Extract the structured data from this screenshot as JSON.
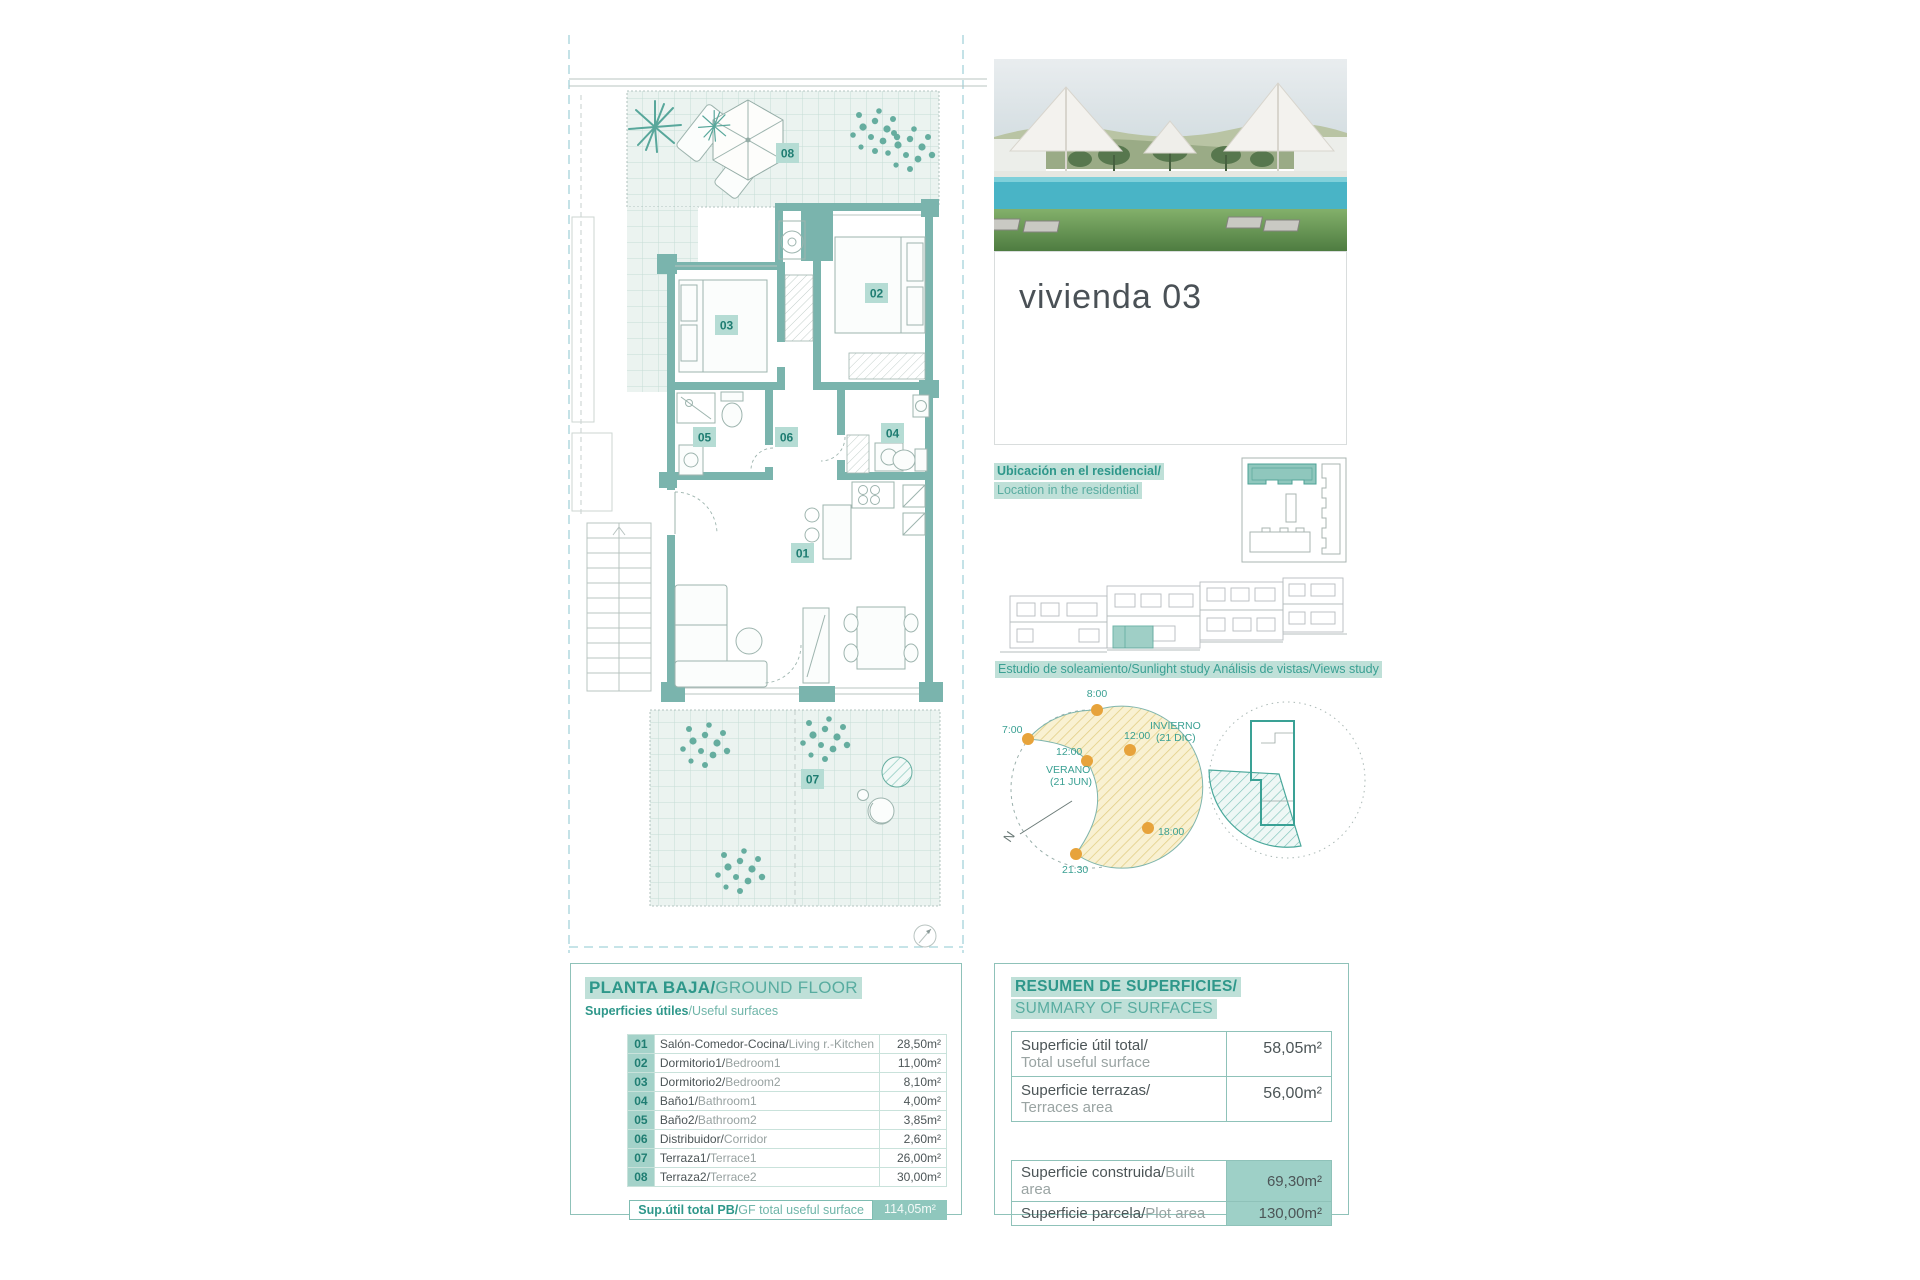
{
  "page": {
    "title": "vivienda 03"
  },
  "location": {
    "line1": "Ubicación en el residencial/",
    "line2": "Location in the residential"
  },
  "studies": {
    "sunlight": "Estudio de soleamiento/Sunlight study",
    "views": "Análisis de vistas/Views study"
  },
  "sun": {
    "t0800": "8:00",
    "t0700": "7:00",
    "t1200_winter": "12:00",
    "t1200_summer": "12:00",
    "t1800": "18:00",
    "t2130": "21:30",
    "winter1": "INVIERNO",
    "winter2": "(21 DIC)",
    "summer1": "VERANO",
    "summer2": "(21 JUN)",
    "north": "N"
  },
  "plan": {
    "rooms": [
      "01",
      "02",
      "03",
      "04",
      "05",
      "06",
      "07",
      "08"
    ]
  },
  "left_table": {
    "header_es": "PLANTA BAJA/",
    "header_en": "GROUND FLOOR",
    "sub_es": "Superficies útiles",
    "sub_en": "/Useful surfaces",
    "rows": [
      {
        "num": "01",
        "es": "Salón-Comedor-Cocina/",
        "en": "Living r.-Kitchen",
        "value": "28,50m²"
      },
      {
        "num": "02",
        "es": "Dormitorio1/",
        "en": "Bedroom1",
        "value": "11,00m²"
      },
      {
        "num": "03",
        "es": "Dormitorio2/",
        "en": "Bedroom2",
        "value": "8,10m²"
      },
      {
        "num": "04",
        "es": "Baño1/",
        "en": "Bathroom1",
        "value": "4,00m²"
      },
      {
        "num": "05",
        "es": "Baño2/",
        "en": "Bathroom2",
        "value": "3,85m²"
      },
      {
        "num": "06",
        "es": "Distribuidor/",
        "en": "Corridor",
        "value": "2,60m²"
      },
      {
        "num": "07",
        "es": "Terraza1/",
        "en": "Terrace1",
        "value": "26,00m²"
      },
      {
        "num": "08",
        "es": "Terraza2/",
        "en": "Terrace2",
        "value": "30,00m²"
      }
    ],
    "total_es": "Sup.útil total PB/",
    "total_en": "GF total useful surface",
    "total_value": "114,05m²"
  },
  "right_table": {
    "header_es": "RESUMEN DE SUPERFICIES/",
    "header_en": "SUMMARY OF SURFACES",
    "rows_top": [
      {
        "es": "Superficie útil total/",
        "en": "Total useful surface",
        "value": "58,05m²"
      },
      {
        "es": "Superficie terrazas/",
        "en": "Terraces area",
        "value": "56,00m²"
      }
    ],
    "rows_bottom": [
      {
        "es": "Superficie construida/",
        "en": "Built area",
        "value": "69,30m²"
      },
      {
        "es": "Superficie parcela/",
        "en": "Plot area",
        "value": "130,00m²"
      }
    ]
  },
  "colors": {
    "teal_dark": "#2e978a",
    "teal_mid": "#58aca0",
    "highlight": "#bfe0d8",
    "wall": "#7ab4ad",
    "accent_fill": "#8fc7bd",
    "sun_dot": "#e7a33b"
  }
}
